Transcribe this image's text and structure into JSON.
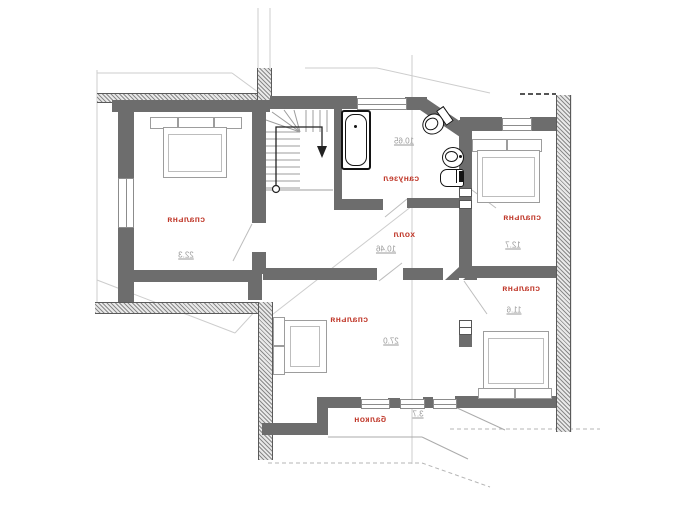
{
  "plan": {
    "type": "floor-plan",
    "language": "ru",
    "text_mirrored": true,
    "rooms": [
      {
        "id": "bedroom-top-left",
        "label": "спальня",
        "area": "22.3"
      },
      {
        "id": "bathroom",
        "label": "санузел",
        "area": "10.65"
      },
      {
        "id": "bedroom-top-right",
        "label": "спальня",
        "area": "12.7"
      },
      {
        "id": "hall",
        "label": "холл",
        "area": "10.46"
      },
      {
        "id": "bedroom-right",
        "label": "спальня",
        "area": "11.6"
      },
      {
        "id": "bedroom-bottom",
        "label": "спальня",
        "area": "27.0"
      },
      {
        "id": "balcony",
        "label": "балкон",
        "area": "3.7"
      }
    ],
    "colors": {
      "wall": "#6d6d6d",
      "room_label": "#c0392b",
      "area_text": "#9a9a9a",
      "thin_line": "#c9c9c9",
      "fixture_line": "#141414"
    }
  }
}
